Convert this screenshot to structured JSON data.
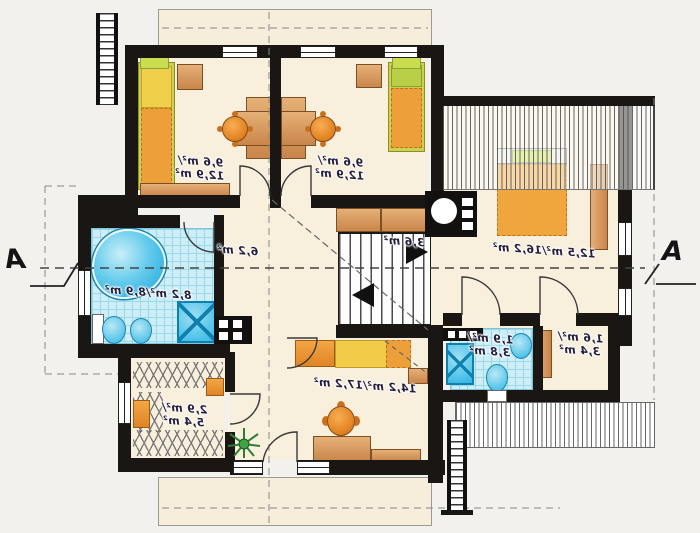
{
  "plan": {
    "title": "attic-floor-plan",
    "section_marker_left": "A",
    "section_marker_right": "A",
    "rooms": {
      "bedroom_left": {
        "area": "9,6 m²/",
        "area_total": "12,9 m²"
      },
      "bedroom_middle": {
        "area": "9,6 m²/",
        "area_total": "12,9 m²"
      },
      "bedroom_right": {
        "area": "12,5 m²/16,2 m²"
      },
      "bathroom": {
        "area": "8,2 m²/8,9 m²"
      },
      "hall": {
        "area": "6,2 m²"
      },
      "staircase": {
        "area": "3,6 m²"
      },
      "wardrobe": {
        "area": "2,9 m²/",
        "area_total": "5,4 m²"
      },
      "bedroom_bottom": {
        "area": "14,2 m²/17,2 m²"
      },
      "wc": {
        "area": "1,9 m²/",
        "area_total": "3,8 m²"
      },
      "storage": {
        "area": "1,6 m²/",
        "area_total": "3,4 m²"
      }
    },
    "colors": {
      "wall": "#191613",
      "floor_cream": "#f8efdc",
      "tile_blue": "#cdeef7",
      "fixture_blue": "#2fb6e6",
      "furniture_orange": "#ee9a3a",
      "furniture_tan": "#d89a5e",
      "bed_yellow": "#f2cb49",
      "bed_lime": "#ccd14f"
    }
  }
}
